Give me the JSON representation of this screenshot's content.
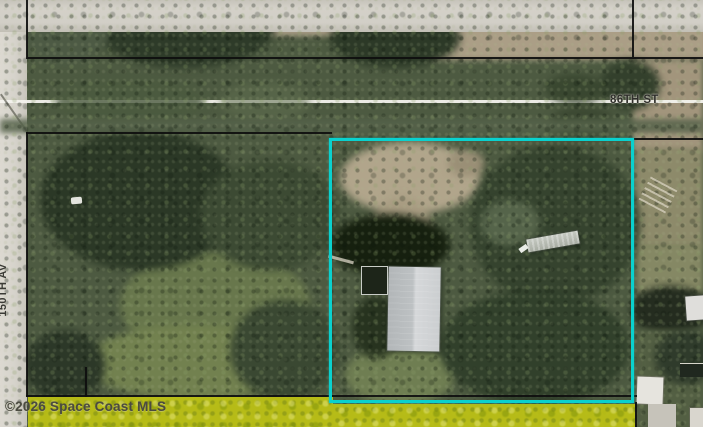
{
  "map": {
    "streets": {
      "horizontal": "86TH ST",
      "vertical": "150TH AV"
    },
    "watermark": "©2026 Space Coast MLS",
    "colors": {
      "selected_parcel_outline": "#0ad1ce",
      "adjacent_parcel_highlight": "#bfc414",
      "parcel_boundary_line": "#0e0e0e",
      "road_surface": "#d2cfc7",
      "road_centerline": "#f4f3ee",
      "street_label_text": "#2f2f2b",
      "watermark_text": "#4b4b40"
    },
    "features": {
      "selected_parcel": "parcel outlined in cyan containing gray metal-roof building",
      "highlighted_strip": "yellow-highlighted strip parcel along bottom edge"
    }
  }
}
